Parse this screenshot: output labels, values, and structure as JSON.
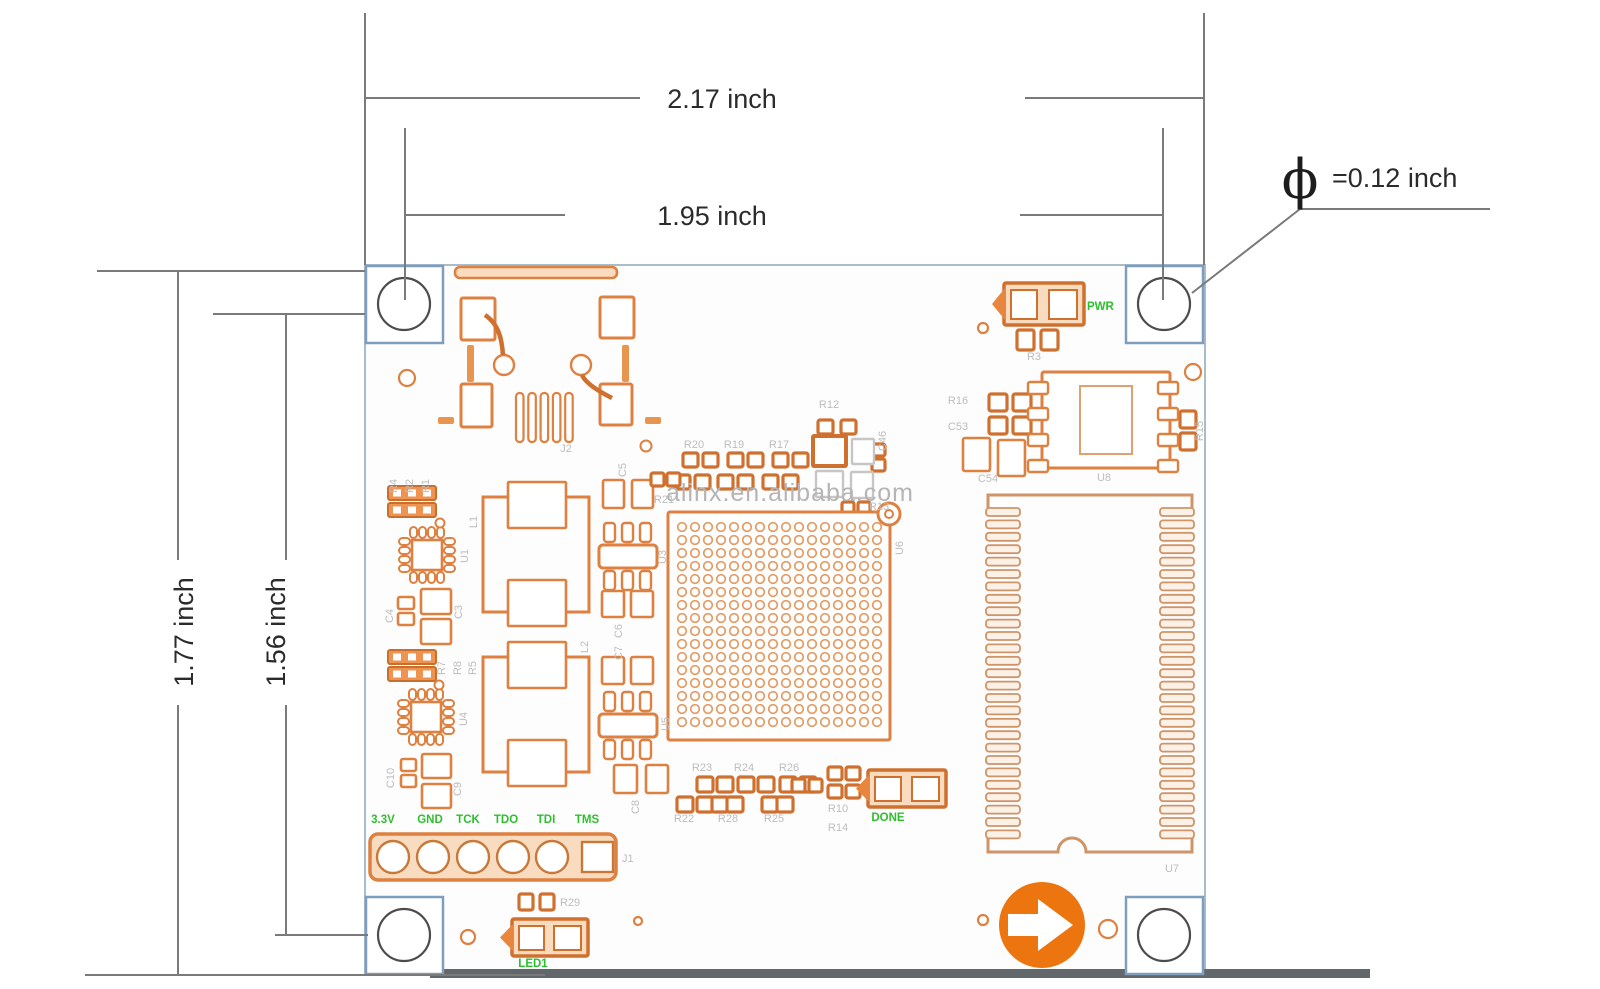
{
  "dimensions": {
    "width_outer": "2.17 inch",
    "width_inner": "1.95 inch",
    "height_outer": "1.77 inch",
    "height_inner": "1.56 inch",
    "hole": {
      "symbol": "ϕ",
      "value": "=0.12 inch"
    }
  },
  "watermark": "alinx.en.alibaba.com",
  "board": {
    "signals": {
      "pwr": "PWR",
      "done": "DONE",
      "led1": "LED1"
    },
    "jtag_pins": [
      "3.3V",
      "GND",
      "TCK",
      "TDO",
      "TDI",
      "TMS"
    ],
    "refdes": {
      "j2": "J2",
      "j1": "J1",
      "u1": "U1",
      "u3": "U3",
      "u4": "U4",
      "u5": "U5",
      "u6": "U6",
      "u7": "U7",
      "u8": "U8",
      "l1": "L1",
      "l2": "L2",
      "r1": "R1",
      "r2": "R2",
      "r3": "R3",
      "r4": "R4",
      "r5": "R5",
      "r7": "R7",
      "r8": "R8",
      "r10": "R10",
      "r12": "R12",
      "r13": "R13",
      "r14": "R14",
      "r15": "R15",
      "r16": "R16",
      "r17": "R17",
      "r19": "R19",
      "r20": "R20",
      "r21": "R21",
      "r22": "R22",
      "r23": "R23",
      "r24": "R24",
      "r25": "R25",
      "r26": "R26",
      "r28": "R28",
      "r29": "R29",
      "c3": "C3",
      "c4": "C4",
      "c5": "C5",
      "c6": "C6",
      "c7": "C7",
      "c8": "C8",
      "c9": "C9",
      "c10": "C10",
      "c46": "C46",
      "c53": "C53",
      "c54": "C54"
    },
    "bga": {
      "rows": 16,
      "cols": 16
    },
    "memory_pins_per_side": 27
  },
  "colors": {
    "copper": "#dd8040",
    "copper_dark": "#cf702e",
    "copper_fill": "#ef9350",
    "pale_fill": "#f9dcc0",
    "tan": "#cf9468",
    "green": "#2ebf2e",
    "gray_label": "#bdbdbd",
    "dim_line": "#7a7a7a",
    "hole_border": "#7f9dbd",
    "hole_ring": "#4c4c4c",
    "board_border": "#a9bcca",
    "logo_orange": "#ed7510",
    "shadow_band": "#62676b"
  }
}
